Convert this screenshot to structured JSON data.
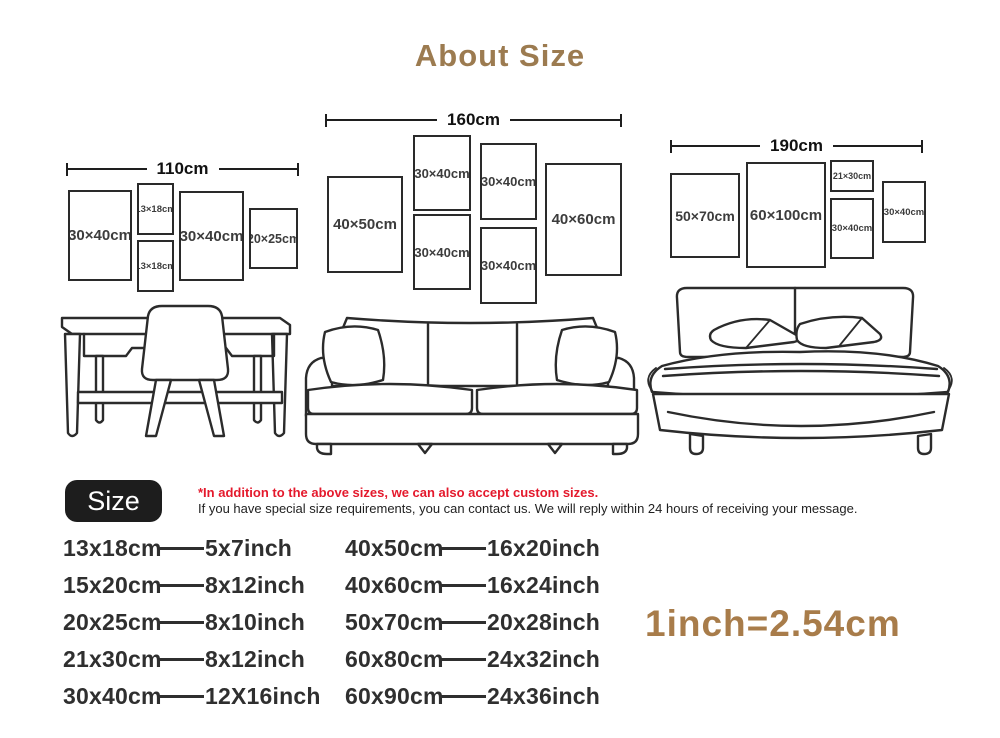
{
  "title": "About Size",
  "groups": [
    {
      "width_label": "110cm",
      "frames": [
        "30×40cm",
        "13×18cm",
        "13×18cm",
        "30×40cm",
        "20×25cm"
      ]
    },
    {
      "width_label": "160cm",
      "frames": [
        "40×50cm",
        "30×40cm",
        "30×40cm",
        "30×40cm",
        "30×40cm",
        "40×60cm"
      ]
    },
    {
      "width_label": "190cm",
      "frames": [
        "50×70cm",
        "60×100cm",
        "21×30cm",
        "30×40cm",
        "30×40cm"
      ]
    }
  ],
  "size_note": {
    "badge_label": "Size",
    "red_note": "*In addition to the above sizes, we can also accept custom sizes.",
    "black_note": "If you have special size requirements, you can contact us. We will reply within 24 hours of receiving your message."
  },
  "conversion": {
    "left_column": [
      {
        "cm": "13x18cm",
        "inch": "5x7inch"
      },
      {
        "cm": "15x20cm",
        "inch": "8x12inch"
      },
      {
        "cm": "20x25cm",
        "inch": "8x10inch"
      },
      {
        "cm": "21x30cm",
        "inch": "8x12inch"
      },
      {
        "cm": "30x40cm",
        "inch": "12X16inch"
      }
    ],
    "right_column": [
      {
        "cm": "40x50cm",
        "inch": "16x20inch"
      },
      {
        "cm": "40x60cm",
        "inch": "16x24inch"
      },
      {
        "cm": "50x70cm",
        "inch": "20x28inch"
      },
      {
        "cm": "60x80cm",
        "inch": "24x32inch"
      },
      {
        "cm": "60x90cm",
        "inch": "24x36inch"
      }
    ],
    "formula": "1inch=2.54cm"
  },
  "colors": {
    "title_brown": "#9c7b50",
    "formula_brown": "#a87c4a",
    "note_red": "#e4192c",
    "line_ink": "#2b2b2b"
  }
}
